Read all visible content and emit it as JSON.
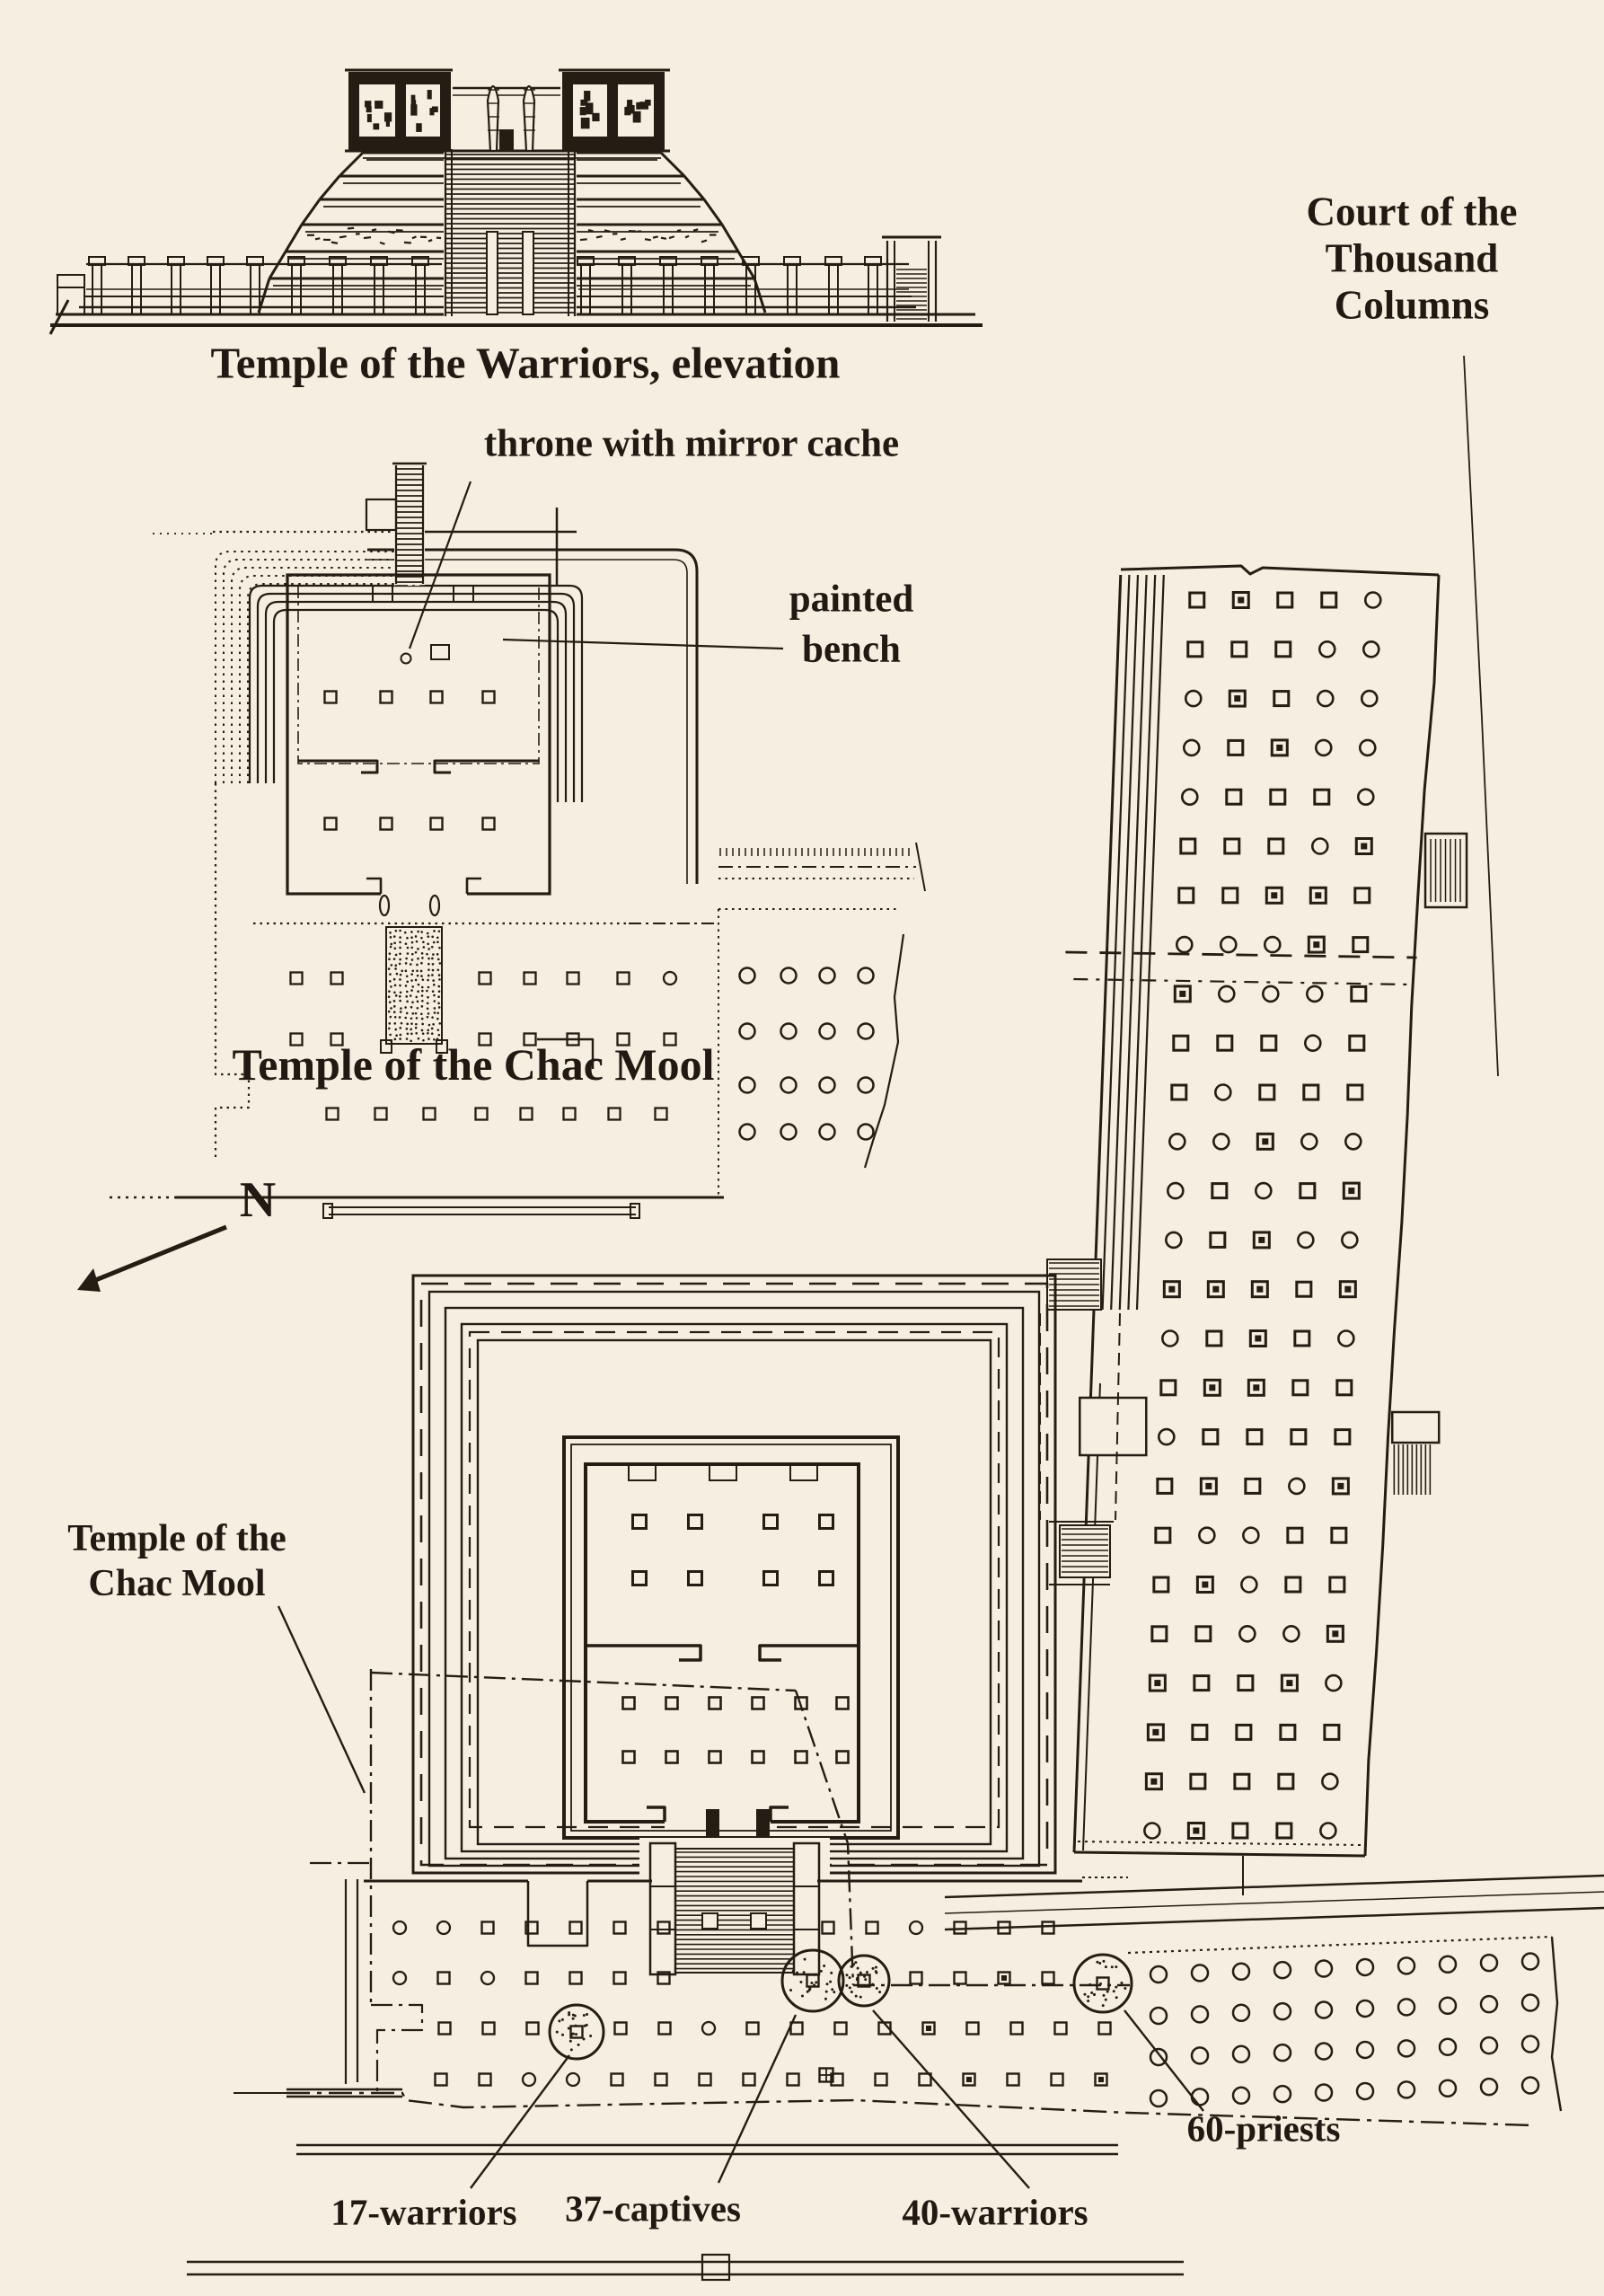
{
  "page": {
    "paper_color": "#f5efe1",
    "ink_color": "#241d13"
  },
  "elevation": {
    "caption": "Temple of the Warriors, elevation"
  },
  "chac_mool": {
    "caption": "Temple of the Chac Mool",
    "throne_label": "throne with mirror cache",
    "bench_line1": "painted",
    "bench_line2": "bench"
  },
  "court": {
    "label_line1": "Court of the",
    "label_line2": "Thousand",
    "label_line3": "Columns"
  },
  "compass": {
    "north_label": "N"
  },
  "plan": {
    "ghost_line1": "Temple of the",
    "ghost_line2": "Chac Mool",
    "count_17": "17-warriors",
    "count_37": "37-captives",
    "count_40": "40-warriors",
    "count_60": "60-priests"
  }
}
